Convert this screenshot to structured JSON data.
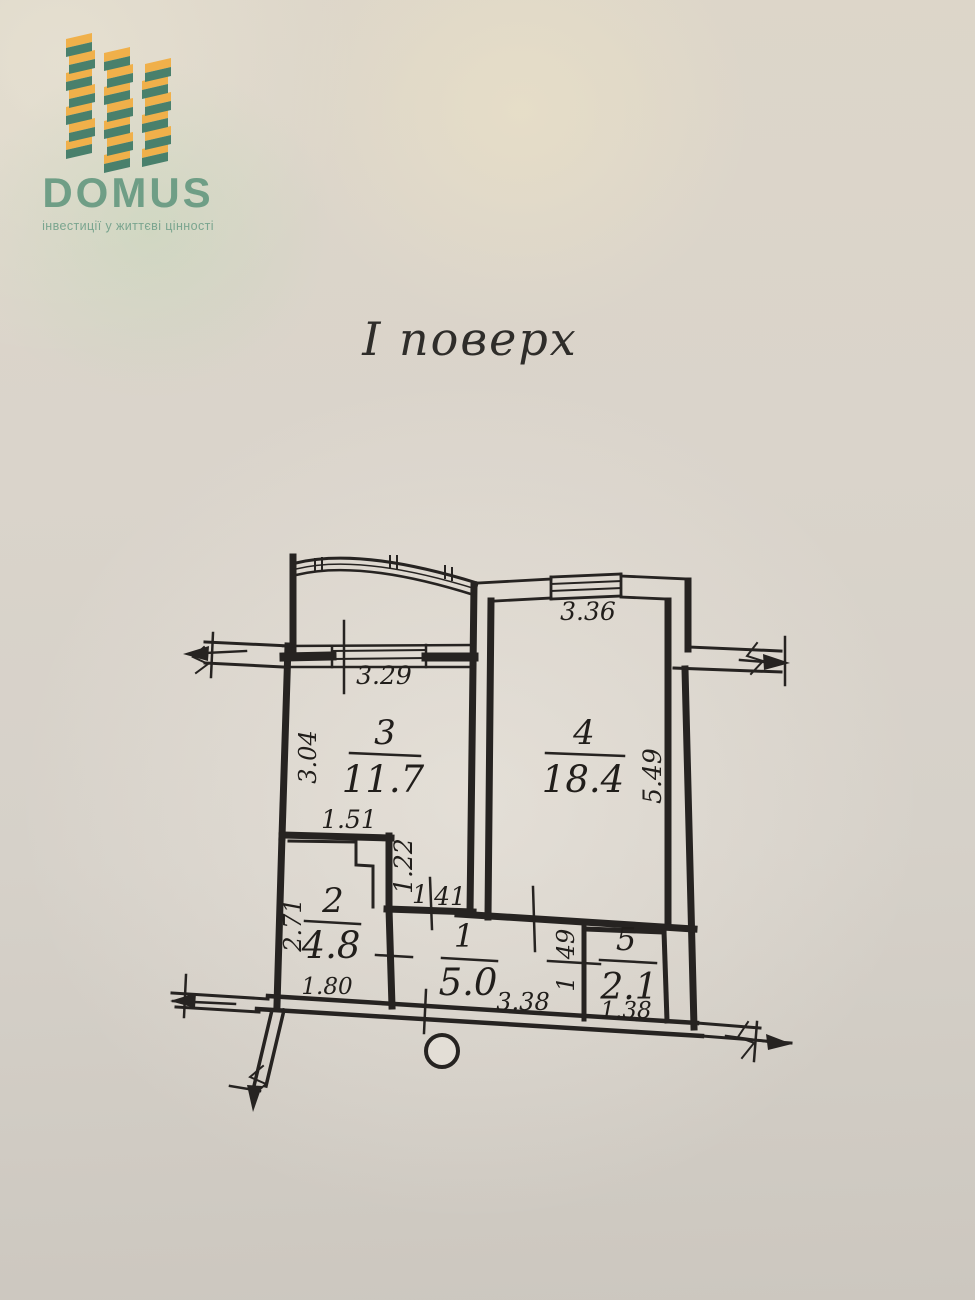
{
  "logo": {
    "brand": "DOMUS",
    "tagline": "інвестиції у життєві цінності",
    "colors": {
      "green": "#6f9e86",
      "yellow": "#f0b04a",
      "teal": "#49806c"
    }
  },
  "title": "І поверх",
  "plan": {
    "rooms": {
      "r1": {
        "number": "1",
        "area": "5.0"
      },
      "r2": {
        "number": "2",
        "area": "4.8"
      },
      "r3": {
        "number": "3",
        "area": "11.7"
      },
      "r4": {
        "number": "4",
        "area": "18.4"
      },
      "r5": {
        "number": "5",
        "area": "2.1"
      }
    },
    "dims": {
      "room4_window_width": "3.36",
      "room3_window_width": "3.29",
      "room3_depth": "3.04",
      "room4_depth": "5.49",
      "notch_width": "1.51",
      "notch_depth": "1.22",
      "passage_width": {
        "value": "1.41",
        "parts": [
          "1",
          "41"
        ]
      },
      "room2_depth": "2.71",
      "room2_width": "1.80",
      "hall_width": "3.38",
      "room5_depth": {
        "value": "1.49",
        "parts": [
          "1",
          "49"
        ]
      },
      "room5_width": "1.38"
    }
  }
}
